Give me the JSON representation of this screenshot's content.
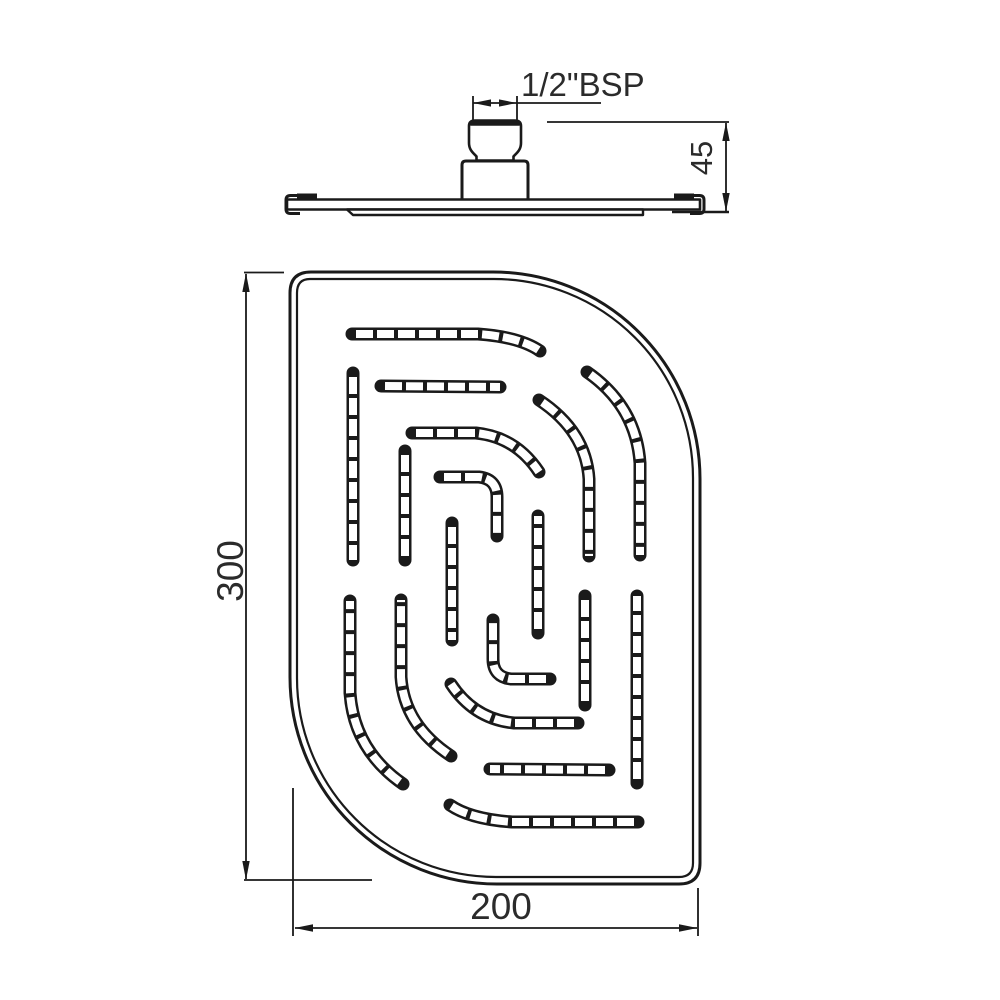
{
  "colors": {
    "background": "#ffffff",
    "line": "#1a1a1a",
    "text": "#2b2b2b",
    "slot_fill": "#ffffff"
  },
  "labels": {
    "thread_size": "1/2\"BSP",
    "height_mm": "45",
    "length_mm": "300",
    "width_mm": "200"
  },
  "drawing": {
    "face_view": {
      "outline_outer": "M290,293 Q290,272 311,272 L493,272 A207,207 0 0 1 700,479 L700,863 Q700,884 679,884 L497,884 A207,207 0 0 1 290,677 Z",
      "outline_inner": "M297,293 Q297,279 310,279 L494,279 A199,199 0 0 1 693,478 L693,863 Q693,877 679,877 L496,877 A199,199 0 0 1 297,678 Z",
      "slots": [
        "M352,334 L478,334 Q520,337 540,351",
        "M353,373 L353,560",
        "M381,386 L500,387",
        "M412,433 L476,433 Q516,437 539,472",
        "M405,451 L405,560",
        "M587,372 Q636,406 640,463 L640,555",
        "M539,400 Q586,431 589,479 L589,556",
        "M452,523 L452,640",
        "M440,477 L479,477 Q497,479 497,497 L497,536",
        "M638,822 L512,822 Q470,819 450,805",
        "M637,783 L637,596",
        "M609,770 L490,769",
        "M578,723 L514,723 Q474,719 451,684",
        "M585,705 L585,596",
        "M403,784 Q354,750 350,693 L350,601",
        "M451,756 Q404,725 401,677 L401,600",
        "M538,633 L538,516",
        "M550,679 L511,679 Q493,677 493,659 L493,620"
      ],
      "slot_stroke_outer": 13,
      "slot_stroke_inner": 8,
      "slot_dash": "17 4",
      "slot_dash_offset": 17
    },
    "side_view": {
      "shapes": [
        {
          "n": "inlet-base-block",
          "d": "M462,199.5 L462,165 Q462,161 466,161 L524,161 Q528,161 528,165 L528,199.5",
          "w": 3,
          "f": "#ffffff"
        },
        {
          "n": "inlet-nipple",
          "d": "M469,143 L469,126 Q469,120.5 475,120.5 L515,120.5 Q521,120.5 521,126 L521,143 C521,150.5 516,153.5 513.5,156.5 L513.5,160.5 L476.5,160.5 L476.5,156.5 C474,153.5 469,150.5 469,143 Z",
          "w": 2.6,
          "f": "#ffffff"
        },
        {
          "n": "inlet-nipple-top-edge",
          "d": "M470.5,123 L519.5,123",
          "w": 5.5
        },
        {
          "n": "plate-profile",
          "d": "M287,199.5 L700,199.5 L700,209.5 L287,209.5 Z",
          "w": 2.6,
          "f": "#ffffff"
        },
        {
          "n": "plate-face-lip",
          "d": "M347,209.5 L643,209.5 L643,215 L353,215 Z",
          "w": 2.4,
          "f": "#ffffff"
        },
        {
          "n": "left-edge-tab",
          "d": "M297,193.5 L317,193.5 L317,199.5 L297,199.5 Z",
          "f": "#1a1a1a"
        },
        {
          "n": "right-edge-tab",
          "d": "M674,193.5 L694,193.5 L694,199.5 L674,199.5 Z",
          "f": "#1a1a1a"
        },
        {
          "n": "left-edge-clip",
          "d": "M300,195.5 L290.5,195.5 Q286,195.5 286,200 L286,209 Q286,213.5 290.5,213.5 L300,213.5",
          "w": 3
        },
        {
          "n": "right-edge-clip",
          "d": "M690,195.5 L699.5,195.5 Q704,195.5 704,200 L704,209 Q704,213.5 699.5,213.5 L690,213.5",
          "w": 3
        }
      ]
    },
    "dimensions": [
      {
        "name": "dim-thread-size",
        "label": "1/2\"BSP",
        "lines": [
          {
            "d": "M473,96 L473,119.5"
          },
          {
            "d": "M517,96 L517,119.5"
          },
          {
            "d": "M473,103 L601,103"
          }
        ],
        "arrows": [
          [
            473,
            103,
            491,
            99.4,
            491,
            106.6
          ],
          [
            517,
            103,
            499,
            99.4,
            499,
            106.6
          ]
        ],
        "text": {
          "x": 521,
          "y": 96,
          "size": 33,
          "anchor": "start",
          "rotate": 0
        }
      },
      {
        "name": "dim-height",
        "label": "45",
        "lines": [
          {
            "d": "M547,122 L729,122"
          },
          {
            "d": "M672,212 L729,212",
            "w": 2.4
          },
          {
            "d": "M726,123 L726,211"
          }
        ],
        "arrows": [
          [
            726,
            122.5,
            722.3,
            141,
            729.7,
            141
          ],
          [
            726,
            211.5,
            722.3,
            193,
            729.7,
            193
          ]
        ],
        "text": {
          "x": 712,
          "y": 158,
          "size": 31,
          "anchor": "middle",
          "rotate": -90
        }
      },
      {
        "name": "dim-length",
        "label": "300",
        "lines": [
          {
            "d": "M244,272.5 L284,272.5"
          },
          {
            "d": "M244,880 L372,880"
          },
          {
            "d": "M246,274 L246,879"
          }
        ],
        "arrows": [
          [
            246,
            273,
            242.3,
            292,
            249.7,
            292
          ],
          [
            246,
            880,
            242.3,
            861,
            249.7,
            861
          ]
        ],
        "text": {
          "x": 243,
          "y": 571,
          "size": 37,
          "anchor": "middle",
          "rotate": -90
        }
      },
      {
        "name": "dim-width",
        "label": "200",
        "lines": [
          {
            "d": "M293,788 L293,936"
          },
          {
            "d": "M698,888 L698,936"
          },
          {
            "d": "M295,928 L697,928"
          }
        ],
        "arrows": [
          [
            294.5,
            928,
            313,
            924.3,
            313,
            931.7
          ],
          [
            697.5,
            928,
            679,
            924.3,
            679,
            931.7
          ]
        ],
        "text": {
          "x": 501,
          "y": 919,
          "size": 37,
          "anchor": "middle",
          "rotate": 0
        }
      }
    ]
  }
}
